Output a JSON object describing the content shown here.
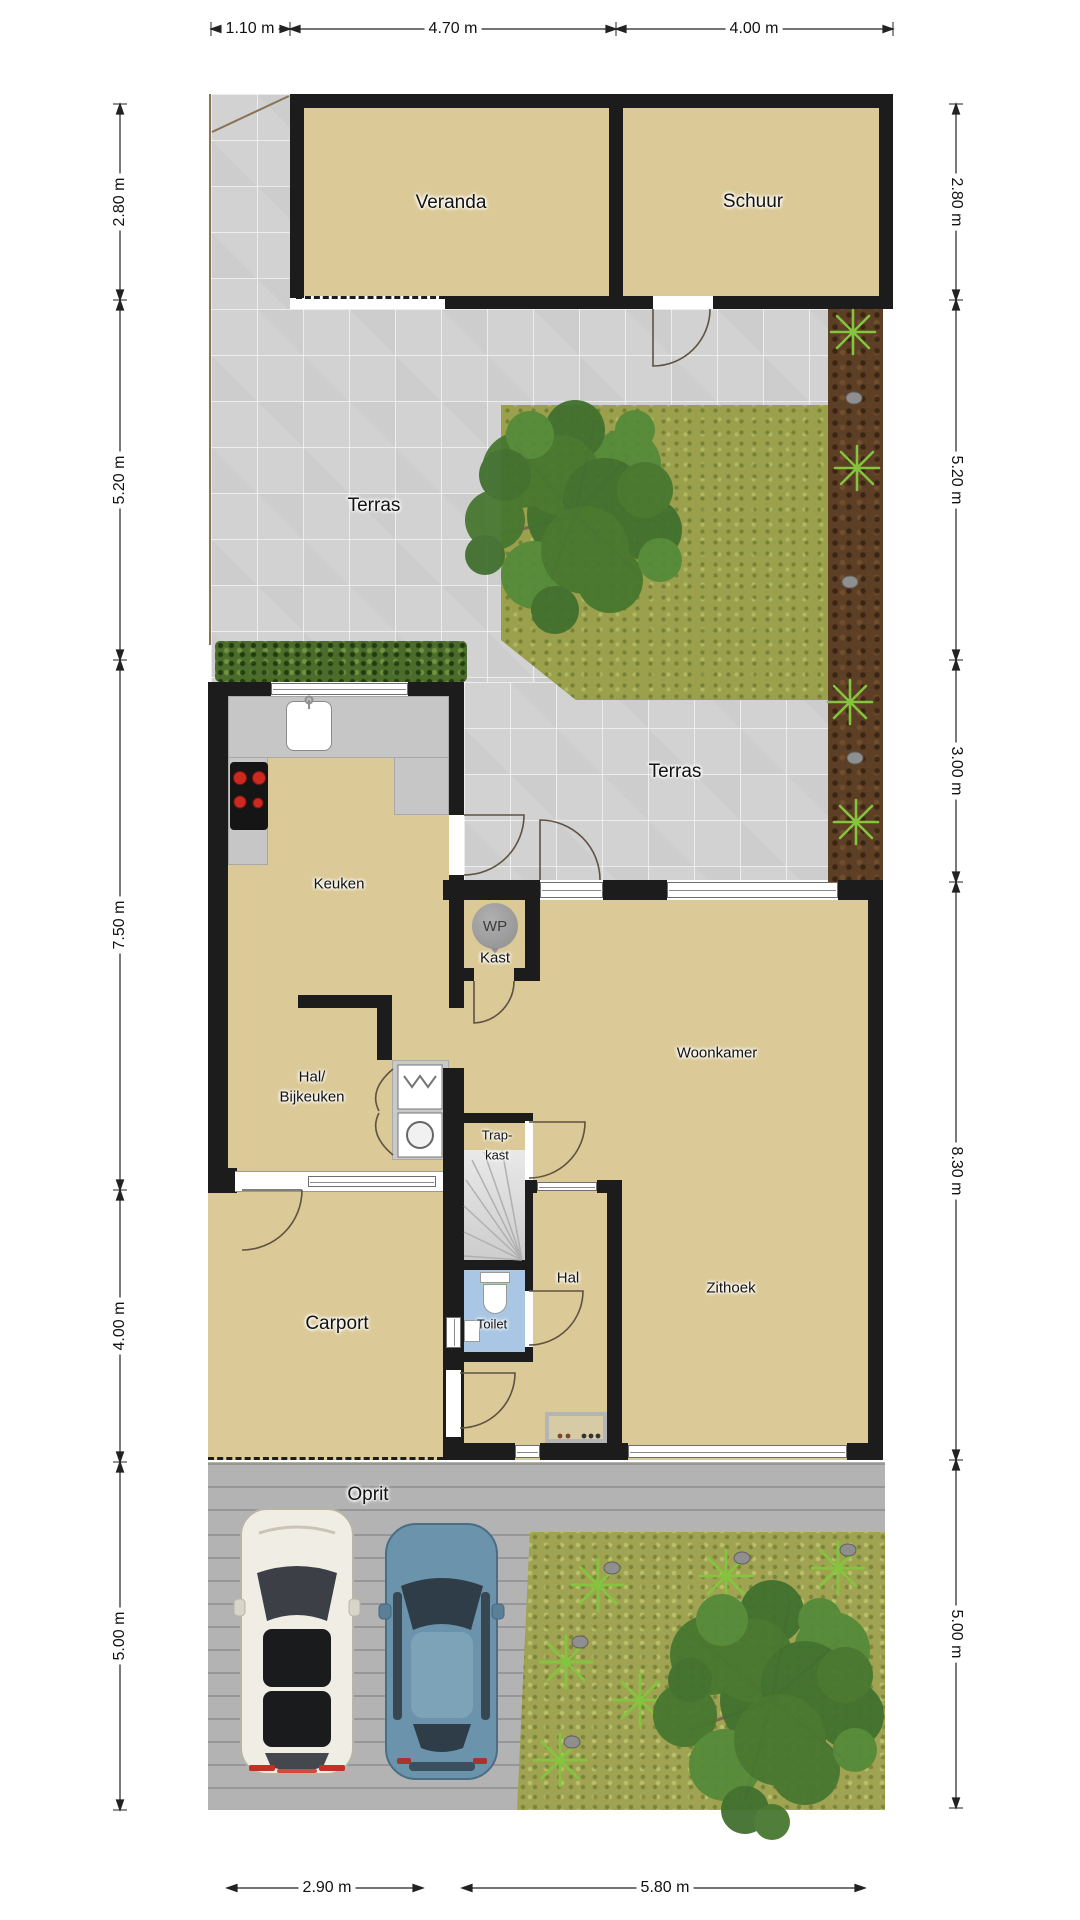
{
  "rooms": {
    "veranda": "Veranda",
    "schuur": "Schuur",
    "terras_boven": "Terras",
    "terras_onder": "Terras",
    "keuken": "Keuken",
    "wp": "WP",
    "wp_kast": "Kast",
    "hal_bijkeuken": [
      "Hal/",
      "Bijkeuken"
    ],
    "trapkast": [
      "Trap-",
      "kast"
    ],
    "woonkamer": "Woonkamer",
    "hal": "Hal",
    "zithoek": "Zithoek",
    "toilet": "Toilet",
    "carport": "Carport",
    "oprit": "Oprit"
  },
  "dimensions": {
    "top": [
      "1.10 m",
      "4.70 m",
      "4.00 m"
    ],
    "left": [
      "2.80 m",
      "5.20 m",
      "7.50 m",
      "4.00 m",
      "5.00 m"
    ],
    "right": [
      "2.80 m",
      "5.20 m",
      "3.00 m",
      "8.30 m",
      "5.00 m"
    ],
    "bottom": [
      "2.90 m",
      "5.80 m"
    ]
  },
  "colors": {
    "wall": "#1c1c1c",
    "floor": "#dbc997",
    "terrace": "#d2d2d2",
    "grass": "#9aa04c",
    "hedge": "#4a6d2b",
    "planting_bed": "#5d3f25",
    "toilet_floor": "#a9c7e4",
    "paving": "#b5b5b5",
    "counter": "#c6c6c6",
    "burner_red": "#cc2a20",
    "car_white": "#f0ede5",
    "car_blue": "#6b93ab",
    "door_arc": "#5f5243"
  }
}
